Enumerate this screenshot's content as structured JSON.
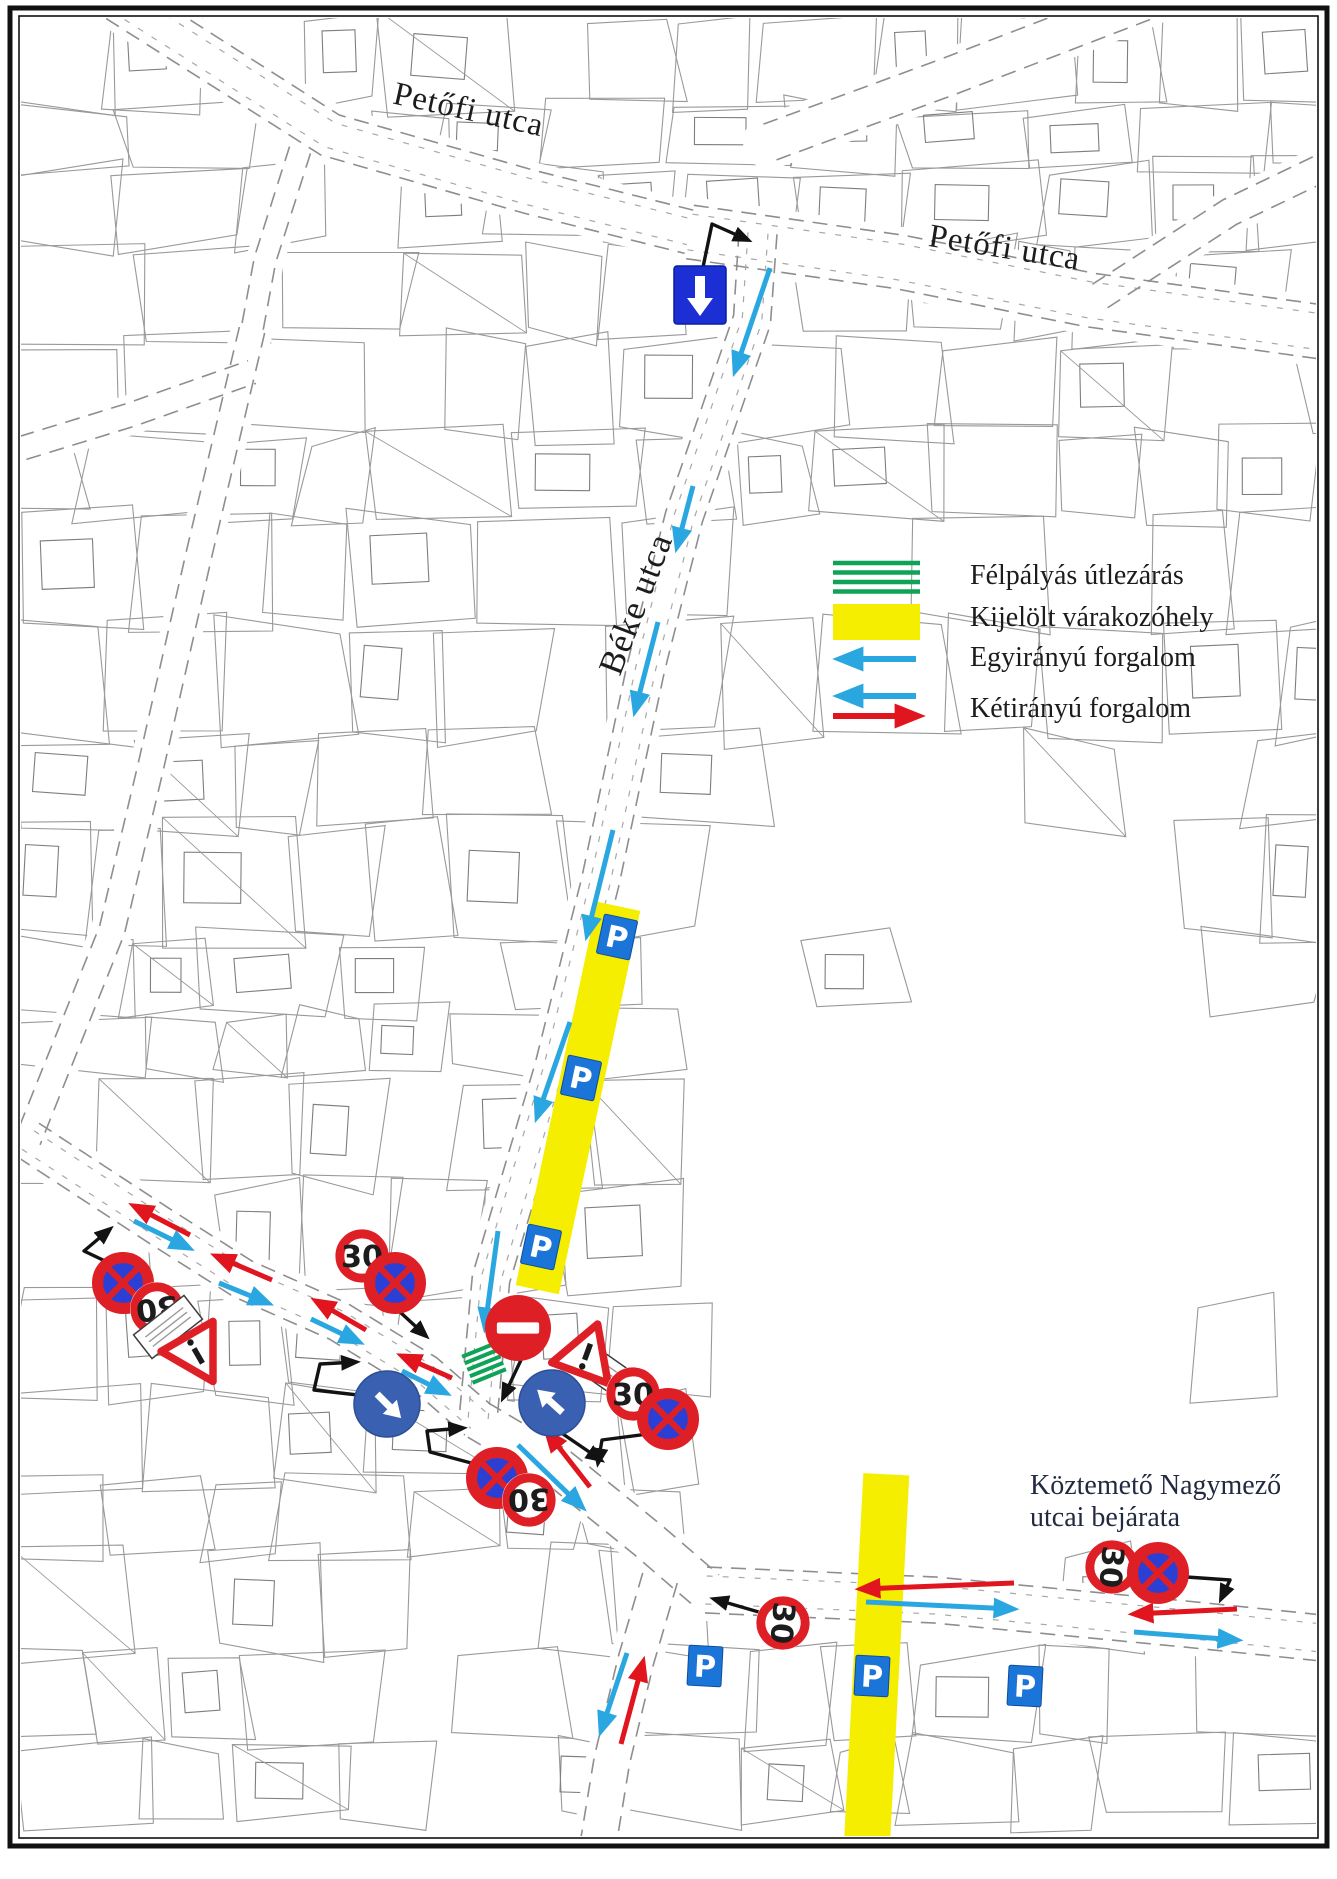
{
  "street_labels": [
    {
      "id": "petofi-1",
      "text": "Petőfi utca"
    },
    {
      "id": "petofi-2",
      "text": "Petőfi utca"
    },
    {
      "id": "beke",
      "text": "Béke utca"
    }
  ],
  "note": {
    "line1": "Köztemető Nagymező",
    "line2": "utcai bejárata"
  },
  "legend": {
    "items": [
      {
        "key": "half-road-closure",
        "swatch": "green-hatch",
        "label": "Félpályás útlezárás"
      },
      {
        "key": "designated-parking",
        "swatch": "yellow-rect",
        "label": "Kijelölt várakozóhely"
      },
      {
        "key": "one-way-traffic",
        "swatch": "blue-arrow",
        "label": "Egyirányú forgalom"
      },
      {
        "key": "two-way-traffic",
        "swatch": "blue-red-arrows",
        "label": "Kétirányú forgalom"
      }
    ]
  },
  "sign_text": {
    "speed_limit": "30",
    "parking": "P"
  },
  "colors": {
    "parcel_line": "#999999",
    "road_dash": "#8e8e8e",
    "frame": "#111111",
    "one_way_blue": "#2aa7e0",
    "two_way_red": "#e0151e",
    "sign_red": "#df1f26",
    "one_way_sign_blue": "#1b2fd4",
    "no_stopping_blue": "#2b3fd4",
    "mandatory_blue": "#3a60b2",
    "parking_blue": "#1b74d8",
    "strip_yellow": "#f6ee00",
    "closure_green": "#0fa357",
    "leader_black": "#121212",
    "text": "#1c1c1c",
    "note_text": "#222a40"
  },
  "map": {
    "roads": [
      {
        "name": "petofi-utca-west",
        "pts": [
          [
            118,
            0
          ],
          [
            330,
            135
          ],
          [
            530,
            192
          ],
          [
            690,
            232
          ]
        ],
        "w": 44,
        "inner": true
      },
      {
        "name": "petofi-utca-east",
        "pts": [
          [
            690,
            232
          ],
          [
            900,
            262
          ],
          [
            1090,
            300
          ],
          [
            1322,
            332
          ]
        ],
        "w": 54,
        "inner": true
      },
      {
        "name": "top-right-street",
        "pts": [
          [
            770,
            142
          ],
          [
            950,
            76
          ],
          [
            1148,
            0
          ]
        ],
        "w": 38,
        "inner": false
      },
      {
        "name": "top-right-street-2",
        "pts": [
          [
            1100,
            296
          ],
          [
            1230,
            212
          ],
          [
            1322,
            168
          ]
        ],
        "w": 28,
        "inner": false
      },
      {
        "name": "beke-utca",
        "pts": [
          [
            758,
            233
          ],
          [
            752,
            320
          ],
          [
            684,
            517
          ],
          [
            646,
            667
          ],
          [
            600,
            883
          ],
          [
            553,
            1070
          ],
          [
            491,
            1279
          ],
          [
            478,
            1420
          ]
        ],
        "w": 38,
        "inner": true
      },
      {
        "name": "west-road",
        "pts": [
          [
            28,
            1140
          ],
          [
            161,
            1227
          ],
          [
            243,
            1279
          ],
          [
            338,
            1321
          ],
          [
            425,
            1374
          ],
          [
            478,
            1420
          ]
        ],
        "w": 40,
        "inner": true
      },
      {
        "name": "southeast-road",
        "pts": [
          [
            478,
            1420
          ],
          [
            559,
            1468
          ],
          [
            648,
            1540
          ],
          [
            706,
            1590
          ]
        ],
        "w": 40,
        "inner": false
      },
      {
        "name": "nagymezo-utca",
        "pts": [
          [
            706,
            1590
          ],
          [
            935,
            1600
          ],
          [
            1185,
            1624
          ],
          [
            1322,
            1638
          ]
        ],
        "w": 46,
        "inner": true
      },
      {
        "name": "south-road",
        "pts": [
          [
            660,
            1578
          ],
          [
            636,
            1660
          ],
          [
            612,
            1760
          ],
          [
            598,
            1845
          ]
        ],
        "w": 36,
        "inner": false
      },
      {
        "name": "left-street",
        "pts": [
          [
            252,
            330
          ],
          [
            200,
            550
          ],
          [
            150,
            770
          ],
          [
            112,
            930
          ],
          [
            60,
            1060
          ],
          [
            28,
            1140
          ]
        ],
        "w": 26,
        "inner": false
      },
      {
        "name": "left-street-2",
        "pts": [
          [
            0,
            455
          ],
          [
            130,
            415
          ],
          [
            252,
            372
          ]
        ],
        "w": 24,
        "inner": false
      },
      {
        "name": "connector-street",
        "pts": [
          [
            300,
            150
          ],
          [
            265,
            260
          ],
          [
            252,
            330
          ]
        ],
        "w": 22,
        "inner": false
      }
    ],
    "signs": [
      {
        "type": "one-way-down",
        "x": 700,
        "y": 295,
        "size": 52
      },
      {
        "type": "speed-30",
        "x": 362,
        "y": 1256,
        "r": 27,
        "rotate": 0
      },
      {
        "type": "no-stopping",
        "x": 395,
        "y": 1283,
        "r": 31
      },
      {
        "type": "no-stopping",
        "x": 123,
        "y": 1283,
        "r": 31
      },
      {
        "type": "speed-30",
        "x": 157,
        "y": 1309,
        "r": 27,
        "rotate": 172
      },
      {
        "type": "warning-priority",
        "x": 196,
        "y": 1352,
        "rotate": 150,
        "plate": {
          "x": 168,
          "y": 1327,
          "rotate": -38
        }
      },
      {
        "type": "no-entry",
        "x": 518,
        "y": 1328,
        "r": 33
      },
      {
        "type": "warning-priority",
        "x": 586,
        "y": 1356,
        "rotate": 20,
        "plate": {
          "x": 613,
          "y": 1377,
          "rotate": 35
        }
      },
      {
        "type": "speed-30",
        "x": 633,
        "y": 1394,
        "r": 27,
        "rotate": 0
      },
      {
        "type": "no-stopping",
        "x": 668,
        "y": 1419,
        "r": 31
      },
      {
        "type": "mandatory-direction",
        "x": 387,
        "y": 1404,
        "r": 33,
        "dir": 135
      },
      {
        "type": "mandatory-direction",
        "x": 552,
        "y": 1403,
        "r": 33,
        "dir": -48
      },
      {
        "type": "no-stopping",
        "x": 497,
        "y": 1478,
        "r": 31
      },
      {
        "type": "speed-30",
        "x": 529,
        "y": 1500,
        "r": 27,
        "rotate": 178
      },
      {
        "type": "speed-30",
        "x": 783,
        "y": 1623,
        "r": 27,
        "rotate": 95
      },
      {
        "type": "speed-30",
        "x": 1112,
        "y": 1567,
        "r": 27,
        "rotate": 95
      },
      {
        "type": "no-stopping",
        "x": 1158,
        "y": 1573,
        "r": 31
      }
    ],
    "parking_strips": [
      {
        "name": "beke-parking-strip",
        "cx": 578,
        "cy": 1098,
        "w": 44,
        "len": 392,
        "rotate": 12,
        "p_signs": [
          [
            617,
            937
          ],
          [
            581,
            1078
          ],
          [
            541,
            1247
          ]
        ]
      },
      {
        "name": "nagymezo-parking-strip",
        "cx": 876,
        "cy": 1671,
        "w": 46,
        "len": 394,
        "rotate": 3,
        "p_signs": [
          [
            705,
            1666
          ],
          [
            872,
            1676
          ],
          [
            1025,
            1686
          ]
        ]
      }
    ],
    "closure_hatches": [
      {
        "x": 484,
        "y": 1363,
        "rotate": -22
      }
    ],
    "one_way_arrows": [
      [
        [
          770,
          268
        ],
        [
          735,
          371
        ]
      ],
      [
        [
          693,
          486
        ],
        [
          677,
          547
        ]
      ],
      [
        [
          658,
          622
        ],
        [
          635,
          711
        ]
      ],
      [
        [
          613,
          830
        ],
        [
          587,
          935
        ]
      ],
      [
        [
          570,
          1022
        ],
        [
          537,
          1117
        ]
      ],
      [
        [
          498,
          1231
        ],
        [
          485,
          1327
        ]
      ]
    ],
    "two_way_arrows": [
      {
        "red": [
          [
            190,
            1235
          ],
          [
            134,
            1206
          ]
        ],
        "blue": [
          [
            134,
            1221
          ],
          [
            189,
            1248
          ]
        ]
      },
      {
        "red": [
          [
            272,
            1280
          ],
          [
            216,
            1256
          ]
        ],
        "blue": [
          [
            219,
            1283
          ],
          [
            268,
            1303
          ]
        ]
      },
      {
        "red": [
          [
            366,
            1330
          ],
          [
            316,
            1301
          ]
        ],
        "blue": [
          [
            311,
            1319
          ],
          [
            359,
            1342
          ]
        ]
      },
      {
        "red": [
          [
            452,
            1378
          ],
          [
            402,
            1356
          ]
        ],
        "blue": [
          [
            402,
            1371
          ],
          [
            446,
            1393
          ]
        ]
      },
      {
        "red": [
          [
            590,
            1487
          ],
          [
            547,
            1432
          ]
        ],
        "blue": [
          [
            518,
            1445
          ],
          [
            582,
            1507
          ]
        ]
      },
      {
        "red": [
          [
            1014,
            1583
          ],
          [
            861,
            1589
          ]
        ],
        "blue": [
          [
            866,
            1602
          ],
          [
            1013,
            1609
          ]
        ]
      },
      {
        "red": [
          [
            1237,
            1609
          ],
          [
            1134,
            1614
          ]
        ],
        "blue": [
          [
            1134,
            1632
          ],
          [
            1237,
            1640
          ]
        ]
      },
      {
        "red": [
          [
            621,
            1744
          ],
          [
            643,
            1662
          ]
        ],
        "blue": [
          [
            627,
            1653
          ],
          [
            601,
            1731
          ]
        ]
      }
    ],
    "leader_arrows": [
      [
        [
          702,
          272
        ],
        [
          712,
          224
        ],
        [
          748,
          240
        ]
      ],
      [
        [
          400,
          1312
        ],
        [
          426,
          1336
        ]
      ],
      [
        [
          384,
          1398
        ],
        [
          314,
          1390
        ],
        [
          320,
          1364
        ],
        [
          356,
          1362
        ]
      ],
      [
        [
          521,
          1360
        ],
        [
          503,
          1398
        ]
      ],
      [
        [
          560,
          1432
        ],
        [
          601,
          1460
        ]
      ],
      [
        [
          656,
          1433
        ],
        [
          602,
          1440
        ],
        [
          598,
          1463
        ]
      ],
      [
        [
          490,
          1468
        ],
        [
          430,
          1452
        ],
        [
          427,
          1431
        ],
        [
          463,
          1428
        ]
      ],
      [
        [
          776,
          1617
        ],
        [
          714,
          1599
        ]
      ],
      [
        [
          1172,
          1576
        ],
        [
          1230,
          1580
        ],
        [
          1221,
          1599
        ]
      ],
      [
        [
          126,
          1271
        ],
        [
          84,
          1251
        ],
        [
          110,
          1229
        ]
      ]
    ]
  }
}
